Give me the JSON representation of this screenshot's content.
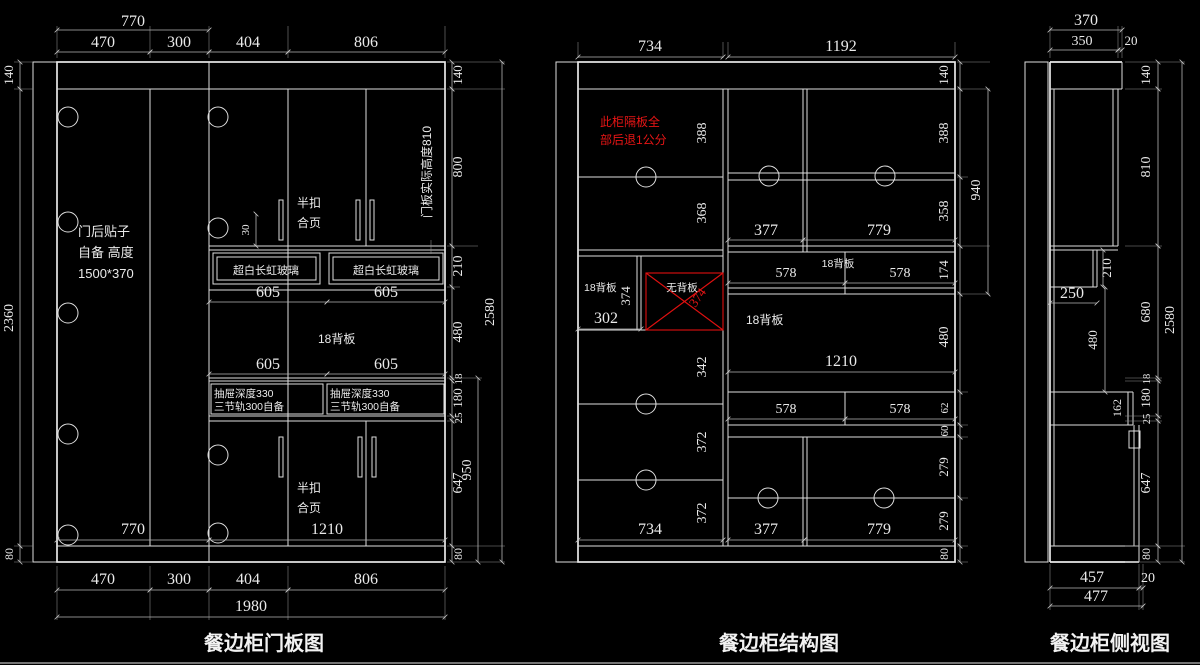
{
  "titles": {
    "door_panel": "餐边柜门板图",
    "structure": "餐边柜结构图",
    "side_view": "餐边柜侧视图"
  },
  "left": {
    "d770": "770",
    "d470": "470",
    "d300": "300",
    "d404": "404",
    "d806": "806",
    "d1980": "1980",
    "d140": "140",
    "d2360": "2360",
    "d80": "80",
    "d800": "800",
    "d210": "210",
    "d480": "480",
    "d18": "18",
    "d180": "180",
    "d25": "25",
    "d647": "647",
    "d950": "950",
    "d2580": "2580",
    "d605": "605",
    "d1210": "1210",
    "d30": "30",
    "note_line1": "门后贴子",
    "note_line2": "自备 高度",
    "note_line3": "1500*370",
    "hinge_line1": "半扣",
    "hinge_line2": "合页",
    "glass": "超白长虹玻璃",
    "backboard": "18背板",
    "drawer_line1": "抽屉深度330",
    "drawer_line2": "三节轨300自备",
    "door_height_note": "门板实际高度810"
  },
  "mid": {
    "d734": "734",
    "d1192": "1192",
    "d140": "140",
    "d388": "388",
    "d368": "368",
    "d358": "358",
    "d374": "374",
    "d342": "342",
    "d372": "372",
    "d302": "302",
    "d174": "174",
    "d480": "480",
    "d62": "62",
    "d60": "60",
    "d279": "279",
    "d80": "80",
    "d940": "940",
    "d377": "377",
    "d779": "779",
    "d578": "578",
    "d1210": "1210",
    "backboard": "18背板",
    "no_backboard": "无背板",
    "red_note_line1": "此柜隔板全",
    "red_note_line2": "部后退1公分"
  },
  "side": {
    "d370": "370",
    "d350": "350",
    "d20": "20",
    "d140": "140",
    "d810": "810",
    "d210": "210",
    "d250": "250",
    "d480": "480",
    "d680": "680",
    "d2580": "2580",
    "d18": "18",
    "d180": "180",
    "d25": "25",
    "d162": "162",
    "d647": "647",
    "d80": "80",
    "d457": "457",
    "d477": "477"
  }
}
